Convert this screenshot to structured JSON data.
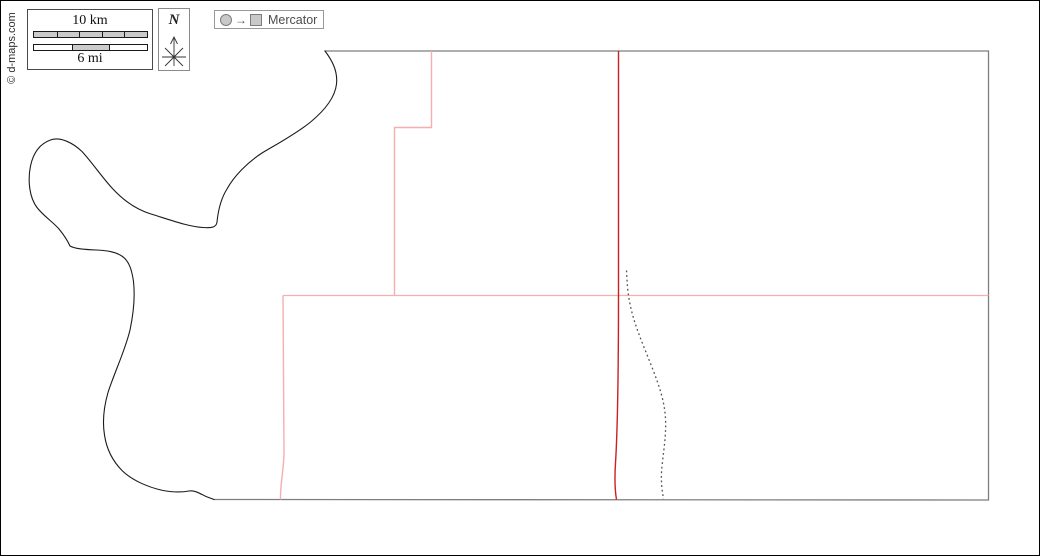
{
  "canvas": {
    "width": 1040,
    "height": 556,
    "background": "#ffffff",
    "frame_color": "#000000"
  },
  "copyright": {
    "text": "© d-maps.com"
  },
  "legend": {
    "scale_bar": {
      "km_label": "10 km",
      "mi_label": "6 mi"
    },
    "compass": {
      "north_label": "N"
    },
    "projection": {
      "arrow_glyph": "→",
      "label": "Mercator"
    }
  },
  "map": {
    "colors": {
      "coastline": "#1b1b1b",
      "straight_edge": "#7e7e7e",
      "primary_boundary": "#cc2020",
      "secondary_boundary": "#f6aeae",
      "dashed_line": "#57524a"
    },
    "paths": {
      "coastline": "M324,50 C330,58 337,69 335.5,83 C334,97 323,110 309,121.5 C294,133.5 276,143 261,152 C247,161 233,175 226,188 C219,199 217,211 216,221 C215.5,227 209,227 202,226.5 C189,226 171,219.5 150,213 C135,208.5 121.5,198.5 111,187 C100.5,175.5 91.5,162 81,150.5 C71.5,141.5 59,135.5 49.5,139 C39.5,142.5 32.5,151 29.5,165 C26.5,180 28.5,196.5 36,206.5 C42.5,215 52,221 58,228 C62.5,233.5 66.5,239.5 69,245 C74.5,248 84,248.5 95.5,249 C105,249.5 114.5,250.5 121.5,255.5 C128.5,260.5 131,270 132.5,280.5 C134,294 133,310 129,329 C124,350 113,372.5 107,391.5 C103,405.5 101,419 103.5,434 C105.5,448 112,460.5 121.5,470 C131,479 146,486 162,489.5 C170.5,491 180,491.5 188,490 C193.5,489 199,492.5 205,495.5 L213,498.5",
      "straight_edges": "M324,50 L987.5,50 L987.5,499 L213,498.5",
      "primary_boundary": "M617.5,50 L617.5,290 C617.5,380 616.5,430 614.5,462 C613.5,478 614,490 615.5,498.5",
      "secondary_upper": "M430.5,50 L430.5,126.5 L393.5,126.5 L393.5,294.5",
      "secondary_horizontal": "M282,294.5 L987.5,294.5",
      "secondary_left": "M282,294.5 L283,450 C283,470 279,482 279.5,498.5",
      "dashed_line": "M625.5,269.5 C626,280 626.5,290 628.5,300.5 C632.5,322 641,341 650.5,365 C658,384 663.5,400 664.5,417.5 C665.5,437 661.5,455 660.5,471.5 C660,485 661.5,491 662.5,498"
    }
  }
}
